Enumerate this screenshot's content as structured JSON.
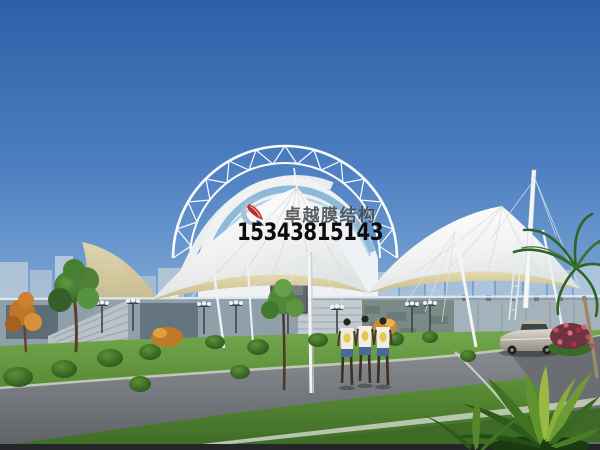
{
  "watermark": {
    "brand_text": "卓越膜结构",
    "phone_number": "15343815143",
    "logo_icon": "sail-swoosh-logo",
    "logo_colors": {
      "crescent": "#a9c0dc",
      "sail": "#bf2d26"
    },
    "brand_text_color": "#46494e",
    "phone_text_color": "#0c0c0e"
  },
  "palette": {
    "sky_top": "#2c60a6",
    "sky_horizon": "#cadded",
    "membrane_white": "#f7f8f6",
    "membrane_underside": "#d9cc9f",
    "truss_white": "#fafcfd",
    "glass_band_blue": "#85b3d6",
    "lawn_green": "#5d9038",
    "road_gray": "#7c8084",
    "wall_gray": "#8fa0aa",
    "shorts_blue": "#49699e",
    "car_silver": "#c5c0b6",
    "flower_red": "#c84a58"
  }
}
